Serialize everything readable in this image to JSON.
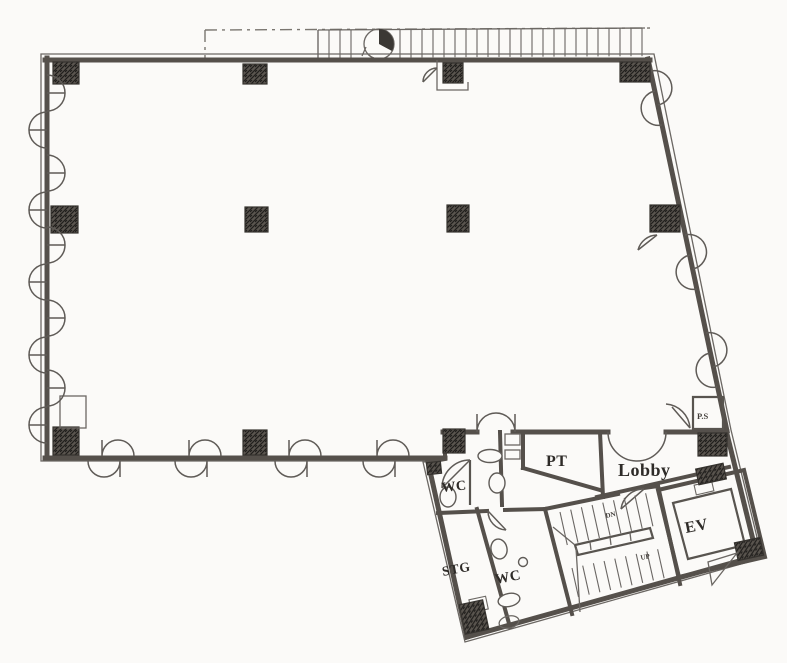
{
  "plan": {
    "rooms": [
      {
        "id": "pt",
        "label": "PT"
      },
      {
        "id": "lobby",
        "label": "Lobby"
      },
      {
        "id": "wc-upper",
        "label": "WC"
      },
      {
        "id": "stg",
        "label": "STG"
      },
      {
        "id": "wc-lower",
        "label": "WC"
      },
      {
        "id": "ev",
        "label": "EV"
      },
      {
        "id": "ps",
        "label": "P.S"
      }
    ],
    "stair_marks": {
      "up": "UP",
      "dn": "DN"
    },
    "colors": {
      "wall": "#55504b",
      "ink": "#3c3835",
      "paper": "#fbfaf8"
    }
  }
}
